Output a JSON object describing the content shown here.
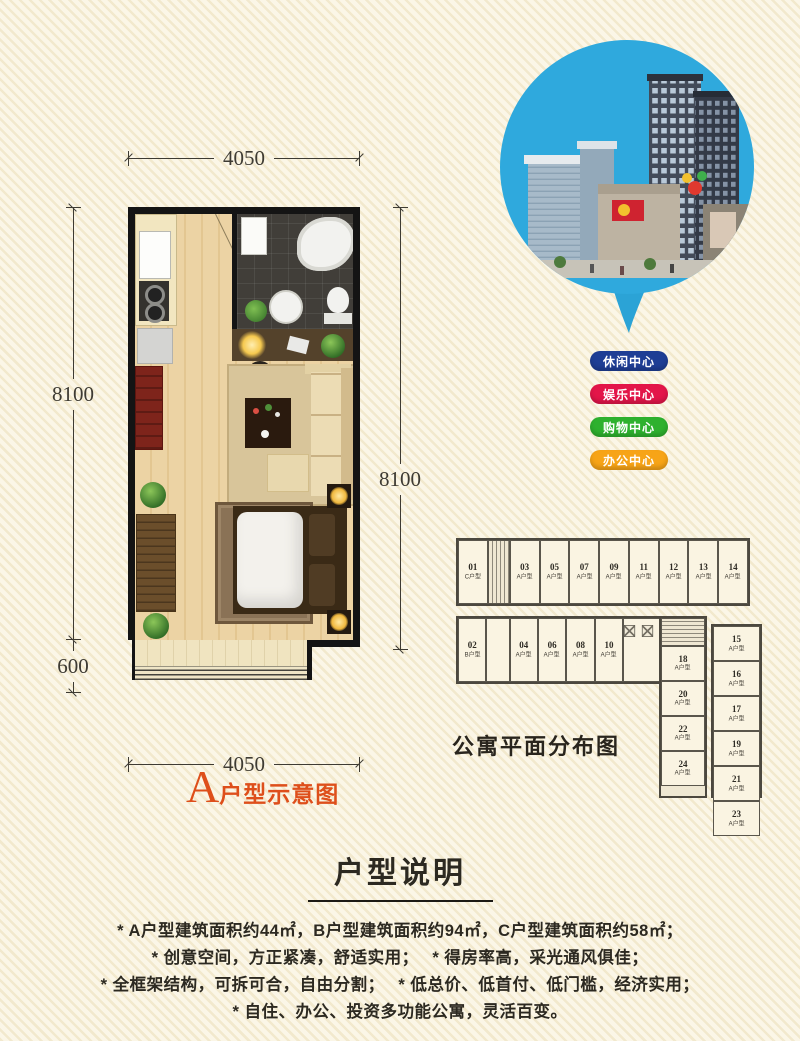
{
  "plan": {
    "dim_top": "4050",
    "dim_left": "8100",
    "dim_left_small": "600",
    "dim_right": "8100",
    "dim_bottom": "4050",
    "label_letter": "A",
    "label_text": "户型示意图"
  },
  "badges": [
    {
      "label": "休闲中心",
      "color": "#1e3e95"
    },
    {
      "label": "娱乐中心",
      "color": "#e31549"
    },
    {
      "label": "购物中心",
      "color": "#2eb12e"
    },
    {
      "label": "办公中心",
      "color": "#f7a417"
    }
  ],
  "apartment_plan": {
    "caption": "公寓平面分布图",
    "top_row": [
      {
        "no": "01",
        "type": "C户型"
      },
      {
        "kind": "stair"
      },
      {
        "no": "03",
        "type": "A户型"
      },
      {
        "no": "05",
        "type": "A户型"
      },
      {
        "no": "07",
        "type": "A户型"
      },
      {
        "no": "09",
        "type": "A户型"
      },
      {
        "no": "11",
        "type": "A户型"
      },
      {
        "no": "12",
        "type": "A户型"
      },
      {
        "no": "13",
        "type": "A户型"
      },
      {
        "no": "14",
        "type": "A户型"
      }
    ],
    "bottom_row": [
      {
        "no": "02",
        "type": "B户型"
      },
      {
        "kind": "hall"
      },
      {
        "no": "04",
        "type": "A户型"
      },
      {
        "no": "06",
        "type": "A户型"
      },
      {
        "no": "08",
        "type": "A户型"
      },
      {
        "no": "10",
        "type": "A户型"
      },
      {
        "kind": "elevators"
      },
      {
        "kind": "lobby"
      }
    ],
    "inner_col": [
      {
        "kind": "stairwell"
      },
      {
        "no": "18",
        "type": "A户型"
      },
      {
        "no": "20",
        "type": "A户型"
      },
      {
        "no": "22",
        "type": "A户型"
      },
      {
        "no": "24",
        "type": "A户型"
      }
    ],
    "outer_col": [
      {
        "no": "15",
        "type": "A户型"
      },
      {
        "no": "16",
        "type": "A户型"
      },
      {
        "no": "17",
        "type": "A户型"
      },
      {
        "no": "19",
        "type": "A户型"
      },
      {
        "no": "21",
        "type": "A户型"
      },
      {
        "no": "23",
        "type": "A户型"
      }
    ]
  },
  "notes": {
    "title": "户型说明",
    "lines": [
      "* A户型建筑面积约44㎡，B户型建筑面积约94㎡，C户型建筑面积约58㎡；",
      "* 创意空间，方正紧凑，舒适实用；　 * 得房率高，采光通风俱佳；",
      "* 全框架结构，可拆可合，自由分割；　 * 低总价、低首付、低门槛，经济实用；",
      "* 自住、办公、投资多功能公寓，灵活百变。"
    ]
  }
}
